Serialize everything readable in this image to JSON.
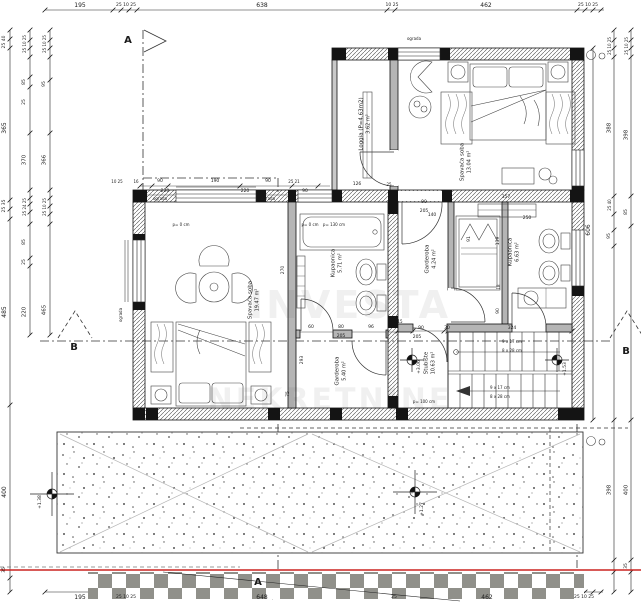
{
  "title": "Floor plan - first floor (tlocrt kata)",
  "colors": {
    "line": "#1b1b1b",
    "wall_hatch": "#4a4a4a",
    "column_fill": "#141414",
    "red_boundary": "#cc2420",
    "checker_gray": "#90908a",
    "terrace_dot": "#555555"
  },
  "watermark": {
    "lines": [
      "INVESTA",
      "NEKRETNINE"
    ]
  },
  "rooms": [
    {
      "id": "loggia",
      "name": "Loggia (P=4.63m2)",
      "area": "3.62 m²",
      "x": 365,
      "y": 124
    },
    {
      "id": "bedroom-1",
      "name": "Spavaća soba",
      "area": "13.04 m²",
      "x": 466,
      "y": 162
    },
    {
      "id": "bedroom-2",
      "name": "Spavaća soba",
      "area": "19.47 m²",
      "x": 254,
      "y": 300
    },
    {
      "id": "bathroom-1",
      "name": "Kupaonica",
      "area": "5.71 m²",
      "x": 337,
      "y": 263
    },
    {
      "id": "wardrobe-1",
      "name": "Garderoba",
      "area": "4.24 m²",
      "x": 431,
      "y": 259
    },
    {
      "id": "bathroom-2",
      "name": "Kupaonica",
      "area": "6.63 m²",
      "x": 514,
      "y": 252
    },
    {
      "id": "wardrobe-2",
      "name": "Garderoba",
      "area": "5.40 m²",
      "x": 341,
      "y": 371
    },
    {
      "id": "staircase",
      "name": "Stubište",
      "area": "10.63 m²",
      "x": 430,
      "y": 363
    }
  ],
  "labels": [
    {
      "t": "195",
      "x": 80,
      "y": 6,
      "s": 6,
      "c": "dim-label"
    },
    {
      "t": "25 10 25",
      "x": 126,
      "y": 6,
      "s": 4.5,
      "c": "dim-label"
    },
    {
      "t": "638",
      "x": 262,
      "y": 6,
      "s": 6,
      "c": "dim-label"
    },
    {
      "t": "10 25",
      "x": 392,
      "y": 6,
      "s": 4.5,
      "c": "dim-label"
    },
    {
      "t": "462",
      "x": 486,
      "y": 6,
      "s": 6,
      "c": "dim-label"
    },
    {
      "t": "25 10 25",
      "x": 588,
      "y": 6,
      "s": 4.5,
      "c": "dim-label"
    },
    {
      "t": "195",
      "x": 80,
      "y": 598,
      "s": 6,
      "c": "dim-label"
    },
    {
      "t": "25 10 25",
      "x": 126,
      "y": 598,
      "s": 4.5,
      "c": "dim-label"
    },
    {
      "t": "648",
      "x": 262,
      "y": 598,
      "s": 6,
      "c": "dim-label"
    },
    {
      "t": "25",
      "x": 394,
      "y": 598,
      "s": 4.5,
      "c": "dim-label"
    },
    {
      "t": "462",
      "x": 487,
      "y": 598,
      "s": 6,
      "c": "dim-label"
    },
    {
      "t": "25 10 25",
      "x": 584,
      "y": 598,
      "s": 4.5,
      "c": "dim-label"
    },
    {
      "t": "25 40",
      "x": 5,
      "y": 42,
      "r": 1,
      "s": 4.5,
      "c": "dim-label"
    },
    {
      "t": "365",
      "x": 5,
      "y": 128,
      "r": 1,
      "s": 6,
      "c": "dim-label"
    },
    {
      "t": "25 35",
      "x": 5,
      "y": 206,
      "r": 1,
      "s": 4.5,
      "c": "dim-label"
    },
    {
      "t": "485",
      "x": 5,
      "y": 312,
      "r": 1,
      "s": 6,
      "c": "dim-label"
    },
    {
      "t": "400",
      "x": 5,
      "y": 492,
      "r": 1,
      "s": 6,
      "c": "dim-label"
    },
    {
      "t": "35",
      "x": 5,
      "y": 570,
      "r": 1,
      "s": 4.5,
      "c": "dim-label"
    },
    {
      "t": "25 10 25",
      "x": 25,
      "y": 44,
      "r": 1,
      "s": 4,
      "c": "dim-label"
    },
    {
      "t": "85",
      "x": 25,
      "y": 82,
      "r": 1,
      "s": 4.5,
      "c": "dim-label"
    },
    {
      "t": "25",
      "x": 25,
      "y": 102,
      "r": 1,
      "s": 4.5,
      "c": "dim-label"
    },
    {
      "t": "370",
      "x": 25,
      "y": 160,
      "r": 1,
      "s": 5.5,
      "c": "dim-label"
    },
    {
      "t": "25 24 25",
      "x": 25,
      "y": 207,
      "r": 1,
      "s": 4,
      "c": "dim-label"
    },
    {
      "t": "85",
      "x": 25,
      "y": 242,
      "r": 1,
      "s": 4.5,
      "c": "dim-label"
    },
    {
      "t": "25",
      "x": 25,
      "y": 262,
      "r": 1,
      "s": 4.5,
      "c": "dim-label"
    },
    {
      "t": "220",
      "x": 25,
      "y": 312,
      "r": 1,
      "s": 5.5,
      "c": "dim-label"
    },
    {
      "t": "25 10 25",
      "x": 45,
      "y": 44,
      "r": 1,
      "s": 4,
      "c": "dim-label"
    },
    {
      "t": "95",
      "x": 45,
      "y": 84,
      "r": 1,
      "s": 4.5,
      "c": "dim-label"
    },
    {
      "t": "366",
      "x": 45,
      "y": 160,
      "r": 1,
      "s": 5.5,
      "c": "dim-label"
    },
    {
      "t": "25 10 25",
      "x": 45,
      "y": 207,
      "r": 1,
      "s": 4,
      "c": "dim-label"
    },
    {
      "t": "465",
      "x": 45,
      "y": 310,
      "r": 1,
      "s": 5.5,
      "c": "dim-label"
    },
    {
      "t": "606",
      "x": 589,
      "y": 230,
      "r": 1,
      "s": 6,
      "c": "dim-label"
    },
    {
      "t": "25 10 25",
      "x": 610,
      "y": 46,
      "r": 1,
      "s": 4,
      "c": "dim-label"
    },
    {
      "t": "388",
      "x": 610,
      "y": 128,
      "r": 1,
      "s": 5.5,
      "c": "dim-label"
    },
    {
      "t": "25 40",
      "x": 610,
      "y": 205,
      "r": 1,
      "s": 4,
      "c": "dim-label"
    },
    {
      "t": "95",
      "x": 610,
      "y": 236,
      "r": 1,
      "s": 4.5,
      "c": "dim-label"
    },
    {
      "t": "398",
      "x": 610,
      "y": 490,
      "r": 1,
      "s": 5.5,
      "c": "dim-label"
    },
    {
      "t": "25 10 25",
      "x": 627,
      "y": 46,
      "r": 1,
      "s": 4,
      "c": "dim-label"
    },
    {
      "t": "398",
      "x": 627,
      "y": 135,
      "r": 1,
      "s": 5.5,
      "c": "dim-label"
    },
    {
      "t": "85",
      "x": 627,
      "y": 212,
      "r": 1,
      "s": 4.5,
      "c": "dim-label"
    },
    {
      "t": "400",
      "x": 627,
      "y": 490,
      "r": 1,
      "s": 5.5,
      "c": "dim-label"
    },
    {
      "t": "35",
      "x": 627,
      "y": 566,
      "r": 1,
      "s": 4.5,
      "c": "dim-label"
    },
    {
      "t": "10 25",
      "x": 117,
      "y": 182,
      "s": 4,
      "c": "dim-label"
    },
    {
      "t": "16",
      "x": 136,
      "y": 182,
      "s": 4,
      "c": "dim-label"
    },
    {
      "t": "90",
      "x": 160,
      "y": 182,
      "s": 4.5,
      "c": "dim-label"
    },
    {
      "t": "190",
      "x": 215,
      "y": 182,
      "s": 4.5,
      "c": "dim-label"
    },
    {
      "t": "90",
      "x": 268,
      "y": 182,
      "s": 4.5,
      "c": "dim-label"
    },
    {
      "t": "25 21",
      "x": 294,
      "y": 182,
      "s": 4,
      "c": "dim-label"
    },
    {
      "t": "220",
      "x": 165,
      "y": 192,
      "s": 4.5,
      "c": "dim-label"
    },
    {
      "t": "220",
      "x": 245,
      "y": 192,
      "s": 4.5,
      "c": "dim-label"
    },
    {
      "t": "90",
      "x": 305,
      "y": 192,
      "s": 4.5,
      "c": "dim-label"
    },
    {
      "t": "126",
      "x": 357,
      "y": 185,
      "s": 4.5,
      "c": "dim-label"
    },
    {
      "t": "25",
      "x": 389,
      "y": 185,
      "s": 4,
      "c": "dim-label"
    },
    {
      "t": "90",
      "x": 424,
      "y": 203,
      "s": 4.5,
      "c": "dim-label"
    },
    {
      "t": "205",
      "x": 424,
      "y": 212,
      "s": 4.5,
      "c": "dim-label"
    },
    {
      "t": "357",
      "x": 506,
      "y": 198,
      "s": 4.5,
      "c": "dim-label"
    },
    {
      "t": "250",
      "x": 527,
      "y": 219,
      "s": 4.5,
      "c": "dim-label"
    },
    {
      "t": "140",
      "x": 432,
      "y": 216,
      "s": 4.5,
      "c": "dim-label"
    },
    {
      "t": "p= 0 cm",
      "x": 181,
      "y": 225,
      "s": 4,
      "c": "note-label"
    },
    {
      "t": "p= 0 cm",
      "x": 310,
      "y": 225,
      "s": 4,
      "c": "note-label"
    },
    {
      "t": "p= 130 cm",
      "x": 334,
      "y": 225,
      "s": 4,
      "c": "note-label"
    },
    {
      "t": "p= 100 cm",
      "x": 424,
      "y": 402,
      "s": 4,
      "c": "note-label"
    },
    {
      "t": "60",
      "x": 311,
      "y": 328,
      "s": 4.5,
      "c": "dim-label"
    },
    {
      "t": "80",
      "x": 341,
      "y": 328,
      "s": 4.5,
      "c": "dim-label"
    },
    {
      "t": "96",
      "x": 371,
      "y": 328,
      "s": 4.5,
      "c": "dim-label"
    },
    {
      "t": "205",
      "x": 341,
      "y": 337,
      "s": 4.5,
      "c": "dim-label"
    },
    {
      "t": "15",
      "x": 400,
      "y": 322,
      "s": 4,
      "c": "dim-label"
    },
    {
      "t": "90",
      "x": 421,
      "y": 329,
      "s": 4.5,
      "c": "dim-label"
    },
    {
      "t": "30",
      "x": 447,
      "y": 329,
      "s": 4.5,
      "c": "dim-label"
    },
    {
      "t": "205",
      "x": 417,
      "y": 338,
      "s": 4.5,
      "c": "dim-label"
    },
    {
      "t": "324",
      "x": 512,
      "y": 329,
      "s": 4.5,
      "c": "dim-label"
    },
    {
      "t": "9 x 17 cm",
      "x": 512,
      "y": 342,
      "s": 4,
      "c": "stair-note"
    },
    {
      "t": "8 x 28 cm",
      "x": 512,
      "y": 351,
      "s": 4,
      "c": "stair-note"
    },
    {
      "t": "9 x 17 cm",
      "x": 500,
      "y": 388,
      "s": 4,
      "c": "stair-note"
    },
    {
      "t": "8 x 28 cm",
      "x": 500,
      "y": 397,
      "s": 4,
      "c": "stair-note"
    },
    {
      "t": "ograda",
      "x": 160,
      "y": 199,
      "s": 4,
      "c": "note-label"
    },
    {
      "t": "ograda",
      "x": 268,
      "y": 199,
      "s": 4,
      "c": "note-label"
    },
    {
      "t": "ograda",
      "x": 414,
      "y": 39,
      "s": 4,
      "c": "note-label"
    },
    {
      "t": "ograda",
      "x": 121,
      "y": 315,
      "r": 1,
      "s": 4,
      "c": "note-label"
    },
    {
      "t": "270",
      "x": 284,
      "y": 270,
      "r": 1,
      "s": 4.5,
      "c": "dim-label"
    },
    {
      "t": "139",
      "x": 499,
      "y": 241,
      "r": 1,
      "s": 4.5,
      "c": "dim-label"
    },
    {
      "t": "91",
      "x": 470,
      "y": 239,
      "r": 1,
      "s": 4.5,
      "c": "dim-label"
    },
    {
      "t": "18",
      "x": 499,
      "y": 287,
      "r": 1,
      "s": 4,
      "c": "dim-label"
    },
    {
      "t": "90",
      "x": 499,
      "y": 311,
      "r": 1,
      "s": 4.5,
      "c": "dim-label"
    },
    {
      "t": "293",
      "x": 303,
      "y": 360,
      "r": 1,
      "s": 4.5,
      "c": "dim-label"
    },
    {
      "t": "75",
      "x": 289,
      "y": 394,
      "r": 1,
      "s": 4.5,
      "c": "dim-label"
    },
    {
      "t": "+3.06",
      "x": 420,
      "y": 367,
      "r": 1,
      "s": 4.5,
      "c": "elevation-label"
    },
    {
      "t": "+1.53",
      "x": 566,
      "y": 369,
      "r": 1,
      "s": 4.5,
      "c": "elevation-label"
    },
    {
      "t": "+1.38",
      "x": 41,
      "y": 502,
      "r": 1,
      "s": 4.5,
      "c": "elevation-label"
    },
    {
      "t": "+1.27",
      "x": 423,
      "y": 509,
      "r": 1,
      "s": 4.5,
      "c": "elevation-label"
    },
    {
      "t": "A",
      "x": 128,
      "y": 41,
      "s": 10,
      "b": 1,
      "c": "section-label"
    },
    {
      "t": "A",
      "x": 258,
      "y": 583,
      "s": 10,
      "b": 1,
      "c": "section-label"
    },
    {
      "t": "B",
      "x": 74,
      "y": 348,
      "s": 10,
      "b": 1,
      "c": "section-label"
    },
    {
      "t": "B",
      "x": 626,
      "y": 352,
      "s": 10,
      "b": 1,
      "c": "section-label"
    }
  ]
}
